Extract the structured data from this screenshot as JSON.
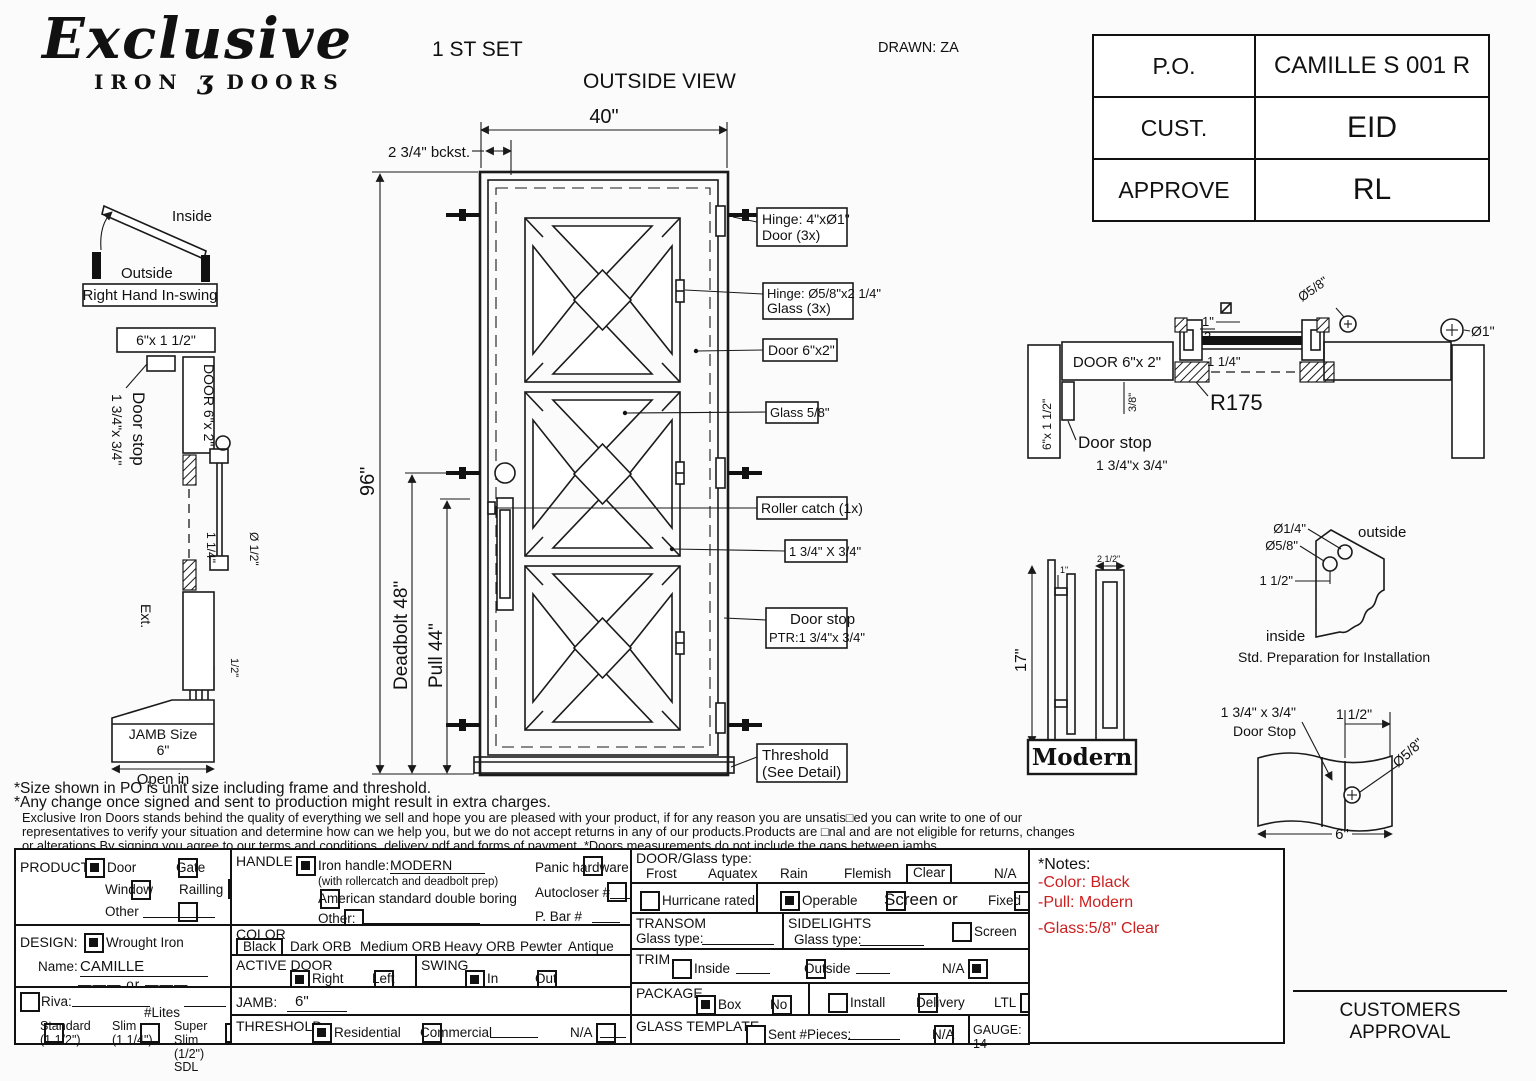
{
  "colors": {
    "accent_red": "#cc2020",
    "line": "#1a1a1a",
    "paper": "#fbfbfb"
  },
  "header": {
    "logo_script": "Exclusive",
    "logo_iron": "IRON",
    "logo_swirl": "ʒ",
    "logo_doors": "DOORS",
    "set_label": "1 ST SET",
    "view_label": "OUTSIDE VIEW",
    "drawn_label": "DRAWN: ZA",
    "info_rows": [
      {
        "label": "P.O.",
        "value": "CAMILLE S 001 R"
      },
      {
        "label": "CUST.",
        "value": "EID"
      },
      {
        "label": "APPROVE",
        "value": "RL"
      }
    ]
  },
  "drawing": {
    "swing": {
      "inside": "Inside",
      "outside": "Outside",
      "label": "Right Hand In-swing"
    },
    "jamb_section": {
      "head": "6\"x 1 1/2\"",
      "door": "DOOR 6\"x 2\"",
      "stop1": "Door stop",
      "stop2": "1 3/4\"x 3/4\"",
      "dim114": "1 1/4\"",
      "dimhalf": "Ø 1/2\"",
      "ext": "Ext.",
      "dim_half_small": "1/2\"",
      "jamb1": "JAMB Size",
      "jamb2": "6\"",
      "jamb3": "Open in"
    },
    "door_view": {
      "dim40": "40\"",
      "bckst": "2 3/4\" bckst.",
      "dim96": "96\"",
      "deadbolt": "Deadbolt 48\"",
      "pull": "Pull 44\"",
      "callout_hinge_door1": "Hinge: 4\"xØ1\"",
      "callout_hinge_door2": "Door (3x)",
      "callout_hinge_glass1": "Hinge: Ø5/8\"x2 1/4\"",
      "callout_hinge_glass2": "Glass (3x)",
      "callout_door": "Door 6\"x2\"",
      "callout_glass": "Glass 5/8\"",
      "callout_roller": "Roller catch  (1x)",
      "callout_bar": "1 3/4\" X 3/4\"",
      "callout_stop1": "Door stop",
      "callout_stop2": "PTR:1 3/4\"x 3/4\"",
      "callout_threshold1": "Threshold",
      "callout_threshold2": "(See Detail)"
    },
    "head_section": {
      "door": "DOOR 6\"x 2\"",
      "jamb": "6\"x 1 1/2\"",
      "r": "R175",
      "dim114": "1 1/4\"",
      "dim38": "3/8\"",
      "phi58": "Ø5/8\"",
      "phi1": "Ø1\"",
      "sq_num": "1\"",
      "sq_den": "2",
      "stop1": "Door stop",
      "stop2": "1 3/4\"x 3/4\""
    },
    "handle": {
      "dim17": "17\"",
      "dim1": "1\"",
      "dim212": "2 1/2\"",
      "name": "Modern"
    },
    "install": {
      "phi14": "Ø1/4\"",
      "phi58": "Ø5/8\"",
      "dim112": "1 1/2\"",
      "outside": "outside",
      "inside": "inside",
      "caption": "Std. Preparation for Installation"
    },
    "stop_detail": {
      "size1": "1 3/4\" x 3/4\"",
      "size2": "Door Stop",
      "dim112": "1 1/2\"",
      "phi58": "Ø5/8\"",
      "dim6": "6\""
    }
  },
  "disclaimer": {
    "line1": "*Size shown in PO is unit size including frame and threshold.",
    "line2": "*Any change once signed and sent to production might result in extra charges.",
    "line3": "Exclusive Iron Doors stands behind the quality of everything we sell and hope you are pleased with your product, if for any reason you are unsatis□ed you can write to one of our",
    "line4": "representatives to verify your situation and determine how can we help you, but we do not accept returns in any of our products.Products are □nal and are not eligible for returns, changes",
    "line5": "or alterations.By signing you agree to our terms and conditions, delivery pdf and forms of payment. *Doors measurements do not include the gaps between jambs"
  },
  "form": {
    "product": {
      "title": "PRODUCT:",
      "door": "Door",
      "gate": "Gate",
      "window": "Window",
      "railing": "Railling",
      "other": "Other"
    },
    "design": {
      "title": "DESIGN:",
      "wrought": "Wrought Iron",
      "name_label": "Name:",
      "name_value": "CAMILLE",
      "or_label": "or"
    },
    "style": {
      "riva": "Riva:",
      "lites": "#Lites",
      "standard": "Standard",
      "standard_size": "(1 1/2\")",
      "slim": "Slim",
      "slim_size": "(1 1/4\")",
      "super_slim": "Super Slim",
      "super_slim_size": "(1/2\") SDL"
    },
    "handle": {
      "title": "HANDLE",
      "iron_handle": "Iron handle:",
      "iron_value": "MODERN",
      "prep_note": "(with rollercatch and deadbolt prep)",
      "american": "American standard double boring",
      "other": "Other:",
      "panic": "Panic hardware",
      "autocloser": "Autocloser #",
      "pbar": "P. Bar #"
    },
    "color": {
      "title": "COLOR",
      "selected": "Black",
      "options": [
        "Dark ORB",
        "Medium ORB",
        "Heavy ORB",
        "Pewter",
        "Antique gold"
      ]
    },
    "active_door": {
      "title": "ACTIVE DOOR",
      "right": "Right",
      "left": "Left"
    },
    "swing": {
      "title": "SWING",
      "in_label": "In",
      "out": "Out"
    },
    "jamb": {
      "title": "JAMB:",
      "value": "6\""
    },
    "threshold": {
      "title": "THRESHOLD",
      "residential": "Residential",
      "commercial": "Commercial",
      "na": "N/A"
    },
    "door_glass": {
      "title": "DOOR/Glass type:",
      "frost": "Frost",
      "aquatex": "Aquatex",
      "rain": "Rain",
      "flemish": "Flemish",
      "clear": "Clear",
      "na": "N/A"
    },
    "hurricane": {
      "label": "Hurricane rated",
      "operable": "Operable",
      "screen_or": "Screen or",
      "fixed": "Fixed"
    },
    "transom": {
      "title": "TRANSOM",
      "glass_type": "Glass type:"
    },
    "sidelights": {
      "title": "SIDELIGHTS",
      "glass_type": "Glass type:",
      "screen": "Screen"
    },
    "trim": {
      "title": "TRIM",
      "inside": "Inside",
      "outside": "Outside",
      "na": "N/A"
    },
    "package": {
      "title": "PACKAGE",
      "box": "Box",
      "no_box": "No box",
      "install": "Install",
      "delivery": "Delivery",
      "ltl": "LTL"
    },
    "glass_template": {
      "title": "GLASS TEMPLATE",
      "sent": "Sent #Pieces:",
      "na": "N/A",
      "gauge": "GAUGE: 14"
    }
  },
  "notes": {
    "title": "*Notes:",
    "color_note": "-Color: Black",
    "pull_note": "-Pull: Modern",
    "glass_note": "-Glass:5/8\"  Clear"
  },
  "approval": {
    "label": "CUSTOMERS APPROVAL"
  }
}
